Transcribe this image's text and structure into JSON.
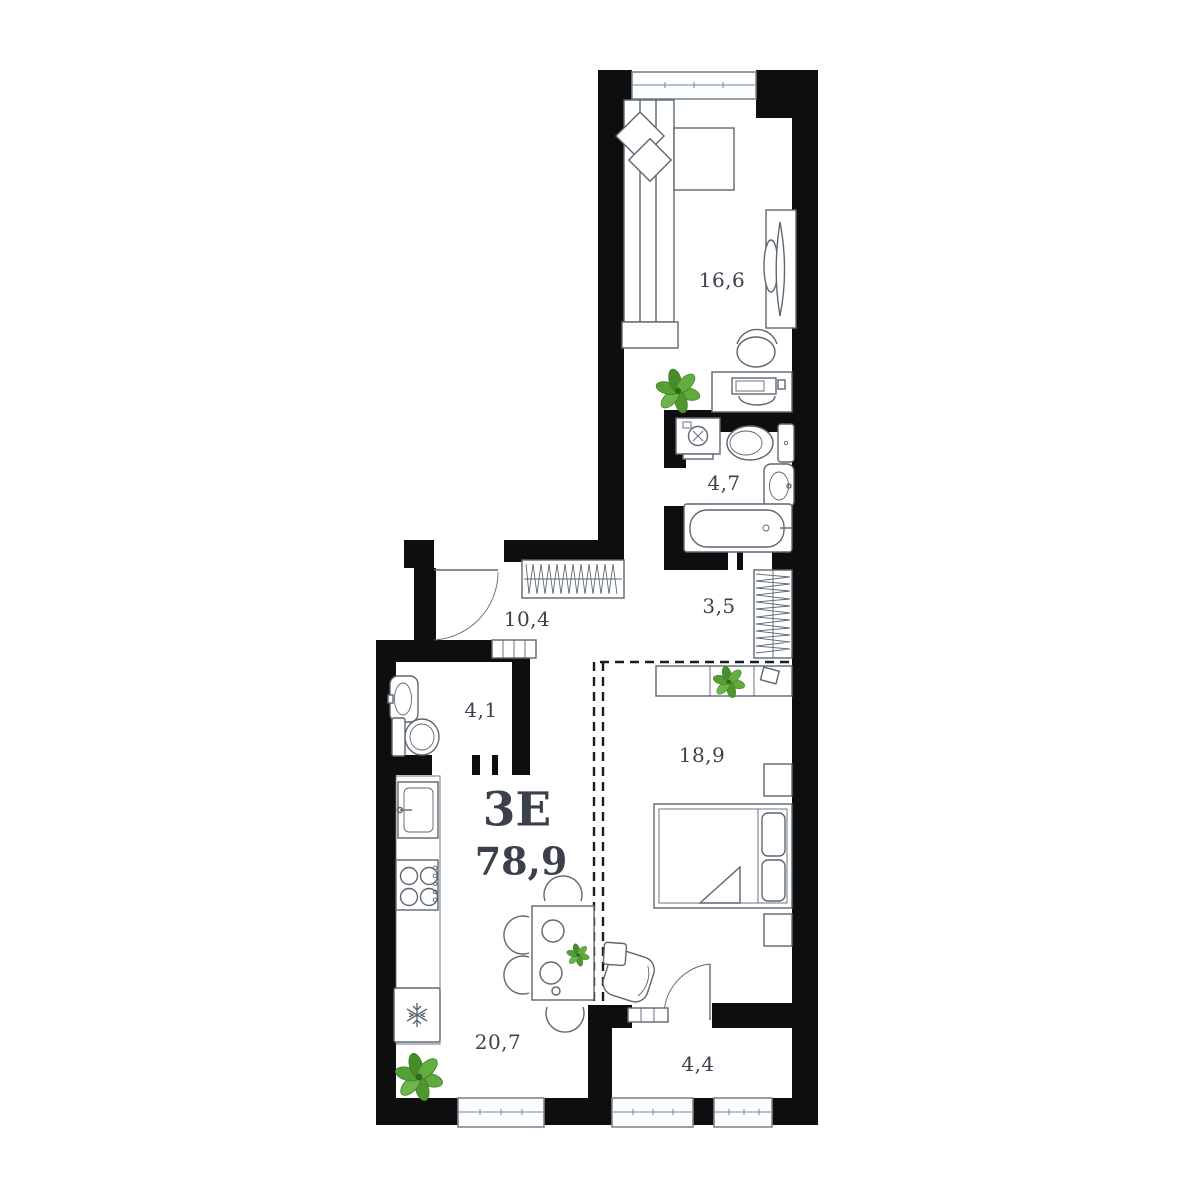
{
  "plan": {
    "unit_label": "3Е",
    "total_area": "78,9",
    "rooms": [
      {
        "name": "living-room",
        "area": "16,6"
      },
      {
        "name": "bathroom",
        "area": "4,7"
      },
      {
        "name": "wardrobe",
        "area": "3,5"
      },
      {
        "name": "hallway",
        "area": "10,4"
      },
      {
        "name": "wc",
        "area": "4,1"
      },
      {
        "name": "bedroom",
        "area": "18,9"
      },
      {
        "name": "kitchen-living",
        "area": "20,7"
      },
      {
        "name": "balcony",
        "area": "4,4"
      }
    ],
    "icons": [
      "plant-icon",
      "snowflake-icon"
    ],
    "colors": {
      "wall": "#0e0e0e",
      "furniture_line": "#5d6770",
      "window_fill": "#fbfdff",
      "window_line": "#7b8893",
      "label_text": "#3b424d",
      "plant_green": "#55a035",
      "background": "#ffffff"
    }
  }
}
